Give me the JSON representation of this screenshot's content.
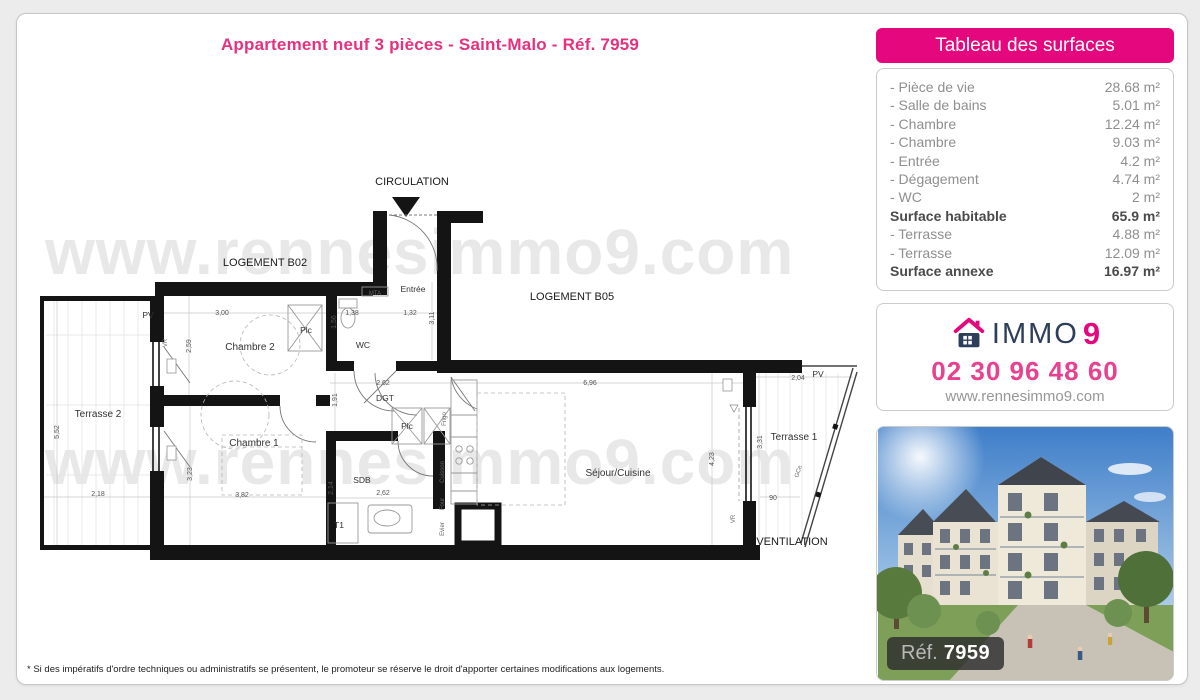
{
  "page": {
    "title": "Appartement neuf 3 pièces - Saint-Malo - Réf. 7959",
    "footnote": "* Si des impératifs d'ordre techniques ou administratifs se présentent, le promoteur se réserve le droit d'apporter certaines modifications aux logements."
  },
  "watermark": "www.rennesimmo9.com",
  "colors": {
    "accent_pink": "#e5077e",
    "brand_navy": "#2c3e5a"
  },
  "surfaces": {
    "header": "Tableau des surfaces",
    "rows": [
      {
        "label": "- Pièce de vie",
        "value": "28.68 m²"
      },
      {
        "label": "- Salle de bains",
        "value": "5.01 m²"
      },
      {
        "label": "- Chambre",
        "value": "12.24 m²"
      },
      {
        "label": "- Chambre",
        "value": "9.03 m²"
      },
      {
        "label": "- Entrée",
        "value": "4.2 m²"
      },
      {
        "label": "- Dégagement",
        "value": "4.74 m²"
      },
      {
        "label": "- WC",
        "value": "2 m²"
      },
      {
        "label": "Surface habitable",
        "value": "65.9 m²"
      },
      {
        "label": "- Terrasse",
        "value": "4.88 m²"
      },
      {
        "label": "- Terrasse",
        "value": "12.09 m²"
      },
      {
        "label": "Surface annexe",
        "value": "16.97 m²"
      }
    ]
  },
  "agency": {
    "brand_immo": "IMMO",
    "brand_9": "9",
    "phone": "02 30 96 48 60",
    "website": "www.rennesimmo9.com"
  },
  "photo": {
    "ref_label": "Réf.",
    "ref_value": "7959"
  },
  "plan": {
    "labels": [
      {
        "t": "CIRCULATION",
        "x": 382,
        "y": 20,
        "c": "zone"
      },
      {
        "t": "LOGEMENT B02",
        "x": 235,
        "y": 101,
        "c": "zone"
      },
      {
        "t": "LOGEMENT B05",
        "x": 542,
        "y": 135,
        "c": "zone"
      },
      {
        "t": "VENTILATION",
        "x": 762,
        "y": 380,
        "c": "zone"
      },
      {
        "t": "Entrée",
        "x": 383,
        "y": 127,
        "c": "small"
      },
      {
        "t": "Chambre 2",
        "x": 220,
        "y": 185,
        "c": "room"
      },
      {
        "t": "Chambre 1",
        "x": 224,
        "y": 281,
        "c": "room"
      },
      {
        "t": "Terrasse 2",
        "x": 68,
        "y": 252,
        "c": "room"
      },
      {
        "t": "Terrasse 1",
        "x": 764,
        "y": 275,
        "c": "room"
      },
      {
        "t": "Séjour/Cuisine",
        "x": 588,
        "y": 311,
        "c": "room"
      },
      {
        "t": "WC",
        "x": 333,
        "y": 183,
        "c": "small"
      },
      {
        "t": "Plc",
        "x": 276,
        "y": 168,
        "c": "small"
      },
      {
        "t": "Plc",
        "x": 377,
        "y": 264,
        "c": "small"
      },
      {
        "t": "DGT",
        "x": 355,
        "y": 236,
        "c": "small"
      },
      {
        "t": "SDB",
        "x": 332,
        "y": 318,
        "c": "small"
      },
      {
        "t": "T1",
        "x": 309,
        "y": 363,
        "c": "small"
      },
      {
        "t": "MTA",
        "x": 345,
        "y": 130,
        "c": "tiny"
      },
      {
        "t": "PV",
        "x": 118,
        "y": 153,
        "c": "small"
      },
      {
        "t": "PV",
        "x": 788,
        "y": 212,
        "c": "small"
      },
      {
        "t": "3,00",
        "x": 192,
        "y": 150,
        "c": "dim"
      },
      {
        "t": "2,59",
        "x": 161,
        "y": 181,
        "c": "dim",
        "r": -90
      },
      {
        "t": "1,56",
        "x": 306,
        "y": 157,
        "c": "dim",
        "r": -90
      },
      {
        "t": "1,38",
        "x": 322,
        "y": 150,
        "c": "dim"
      },
      {
        "t": "1,32",
        "x": 380,
        "y": 150,
        "c": "dim"
      },
      {
        "t": "3,11",
        "x": 404,
        "y": 153,
        "c": "dim",
        "r": -90
      },
      {
        "t": "2,62",
        "x": 353,
        "y": 220,
        "c": "dim"
      },
      {
        "t": "1,91",
        "x": 307,
        "y": 235,
        "c": "dim",
        "r": -90
      },
      {
        "t": "6,96",
        "x": 560,
        "y": 220,
        "c": "dim"
      },
      {
        "t": "4,23",
        "x": 684,
        "y": 294,
        "c": "dim",
        "r": -90
      },
      {
        "t": "3,23",
        "x": 162,
        "y": 309,
        "c": "dim",
        "r": -90
      },
      {
        "t": "3,82",
        "x": 212,
        "y": 332,
        "c": "dim"
      },
      {
        "t": "2,18",
        "x": 68,
        "y": 331,
        "c": "dim"
      },
      {
        "t": "5,52",
        "x": 29,
        "y": 267,
        "c": "dim",
        "r": -90
      },
      {
        "t": "2,14",
        "x": 303,
        "y": 323,
        "c": "dim",
        "r": -90
      },
      {
        "t": "2,62",
        "x": 353,
        "y": 330,
        "c": "dim"
      },
      {
        "t": "2,04",
        "x": 768,
        "y": 215,
        "c": "dim"
      },
      {
        "t": "3,31",
        "x": 732,
        "y": 277,
        "c": "dim",
        "r": -90
      },
      {
        "t": "90",
        "x": 743,
        "y": 335,
        "c": "dim"
      },
      {
        "t": "GCe",
        "x": 770,
        "y": 307,
        "c": "tiny",
        "r": -72
      },
      {
        "t": "VR",
        "x": 137,
        "y": 178,
        "c": "tiny",
        "r": -90
      },
      {
        "t": "VR",
        "x": 705,
        "y": 354,
        "c": "tiny",
        "r": -90
      },
      {
        "t": "Frigo",
        "x": 416,
        "y": 254,
        "c": "tiny",
        "r": -90
      },
      {
        "t": "Cuisson",
        "x": 414,
        "y": 307,
        "c": "tiny",
        "r": -90
      },
      {
        "t": "Four",
        "x": 414,
        "y": 339,
        "c": "tiny",
        "r": -90
      },
      {
        "t": "Evier",
        "x": 414,
        "y": 364,
        "c": "tiny",
        "r": -90
      }
    ]
  }
}
